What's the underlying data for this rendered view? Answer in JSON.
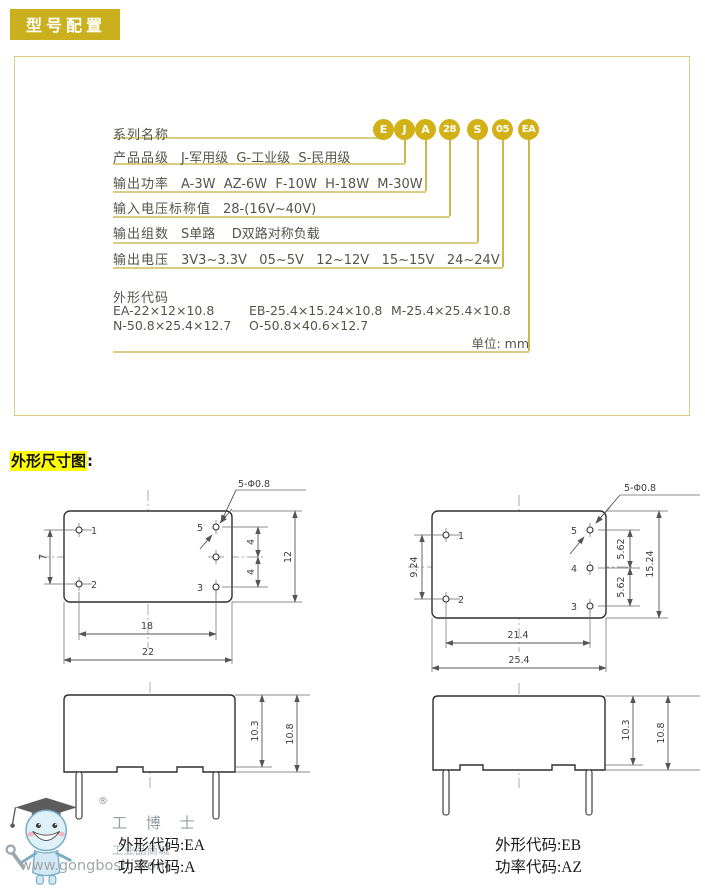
{
  "header": {
    "badge": "型号配置"
  },
  "section2": {
    "label": "外形尺寸图",
    "colon": ":"
  },
  "model": {
    "rows": [
      {
        "label": "系列名称",
        "content": ""
      },
      {
        "label": "产品品级",
        "content": "J-军用级  G-工业级  S-民用级"
      },
      {
        "label": "输出功率",
        "content": "A-3W  AZ-6W  F-10W  H-18W  M-30W"
      },
      {
        "label": "输入电压标称值",
        "content": "28-(16V~40V)"
      },
      {
        "label": "输出组数",
        "content": "S单路    D双路对称负载"
      },
      {
        "label": "输出电压",
        "content": "3V3~3.3V   05~5V   12~12V   15~15V   24~24V"
      }
    ],
    "badges": [
      {
        "text": "E"
      },
      {
        "text": "J"
      },
      {
        "text": "A"
      },
      {
        "text": "28"
      },
      {
        "text": "S"
      },
      {
        "text": "05"
      },
      {
        "text": "EA"
      }
    ],
    "outline": {
      "title": "外形代码",
      "row1": [
        "EA-22×12×10.8",
        "EB-25.4×15.24×10.8",
        "M-25.4×25.4×10.8"
      ],
      "row2": [
        "N-50.8×25.4×12.7",
        "O-50.8×40.6×12.7"
      ],
      "unit": "单位: mm"
    }
  },
  "drawings": {
    "ea_top": {
      "hole_note": "5-Φ0.8",
      "pins": {
        "p1": "1",
        "p2": "2",
        "p3": "3",
        "p5": "5"
      },
      "dims": {
        "left": "7",
        "right_upper": "4",
        "right_lower": "4",
        "height": "12",
        "pin_span": "18",
        "width": "22"
      }
    },
    "eb_top": {
      "hole_note": "5-Φ0.8",
      "pins": {
        "p1": "1",
        "p2": "2",
        "p3": "3",
        "p4": "4",
        "p5": "5"
      },
      "dims": {
        "left": "9.24",
        "right_upper": "5.62",
        "right_lower": "5.62",
        "height": "15.24",
        "pin_span": "21.4",
        "width": "25.4"
      }
    },
    "ea_side": {
      "dims": {
        "body": "10.3",
        "total": "10.8"
      }
    },
    "eb_side": {
      "dims": {
        "body": "10.3",
        "total": "10.8"
      }
    },
    "captions": {
      "ea_outline": "外形代码:EA",
      "ea_power": "功率代码:A",
      "eb_outline": "外形代码:EB",
      "eb_power": "功率代码:AZ"
    }
  },
  "watermark": {
    "reg": "®",
    "brand": "工 博 士",
    "mall": "工业品商城",
    "url": "www.gongboshi.com"
  },
  "colors": {
    "gold_badge": "#c9b01c",
    "badge_circle": "#d2b116",
    "box_border": "#d8cb80",
    "row_line": "#d9cd82",
    "highlight": "#ffff00"
  }
}
